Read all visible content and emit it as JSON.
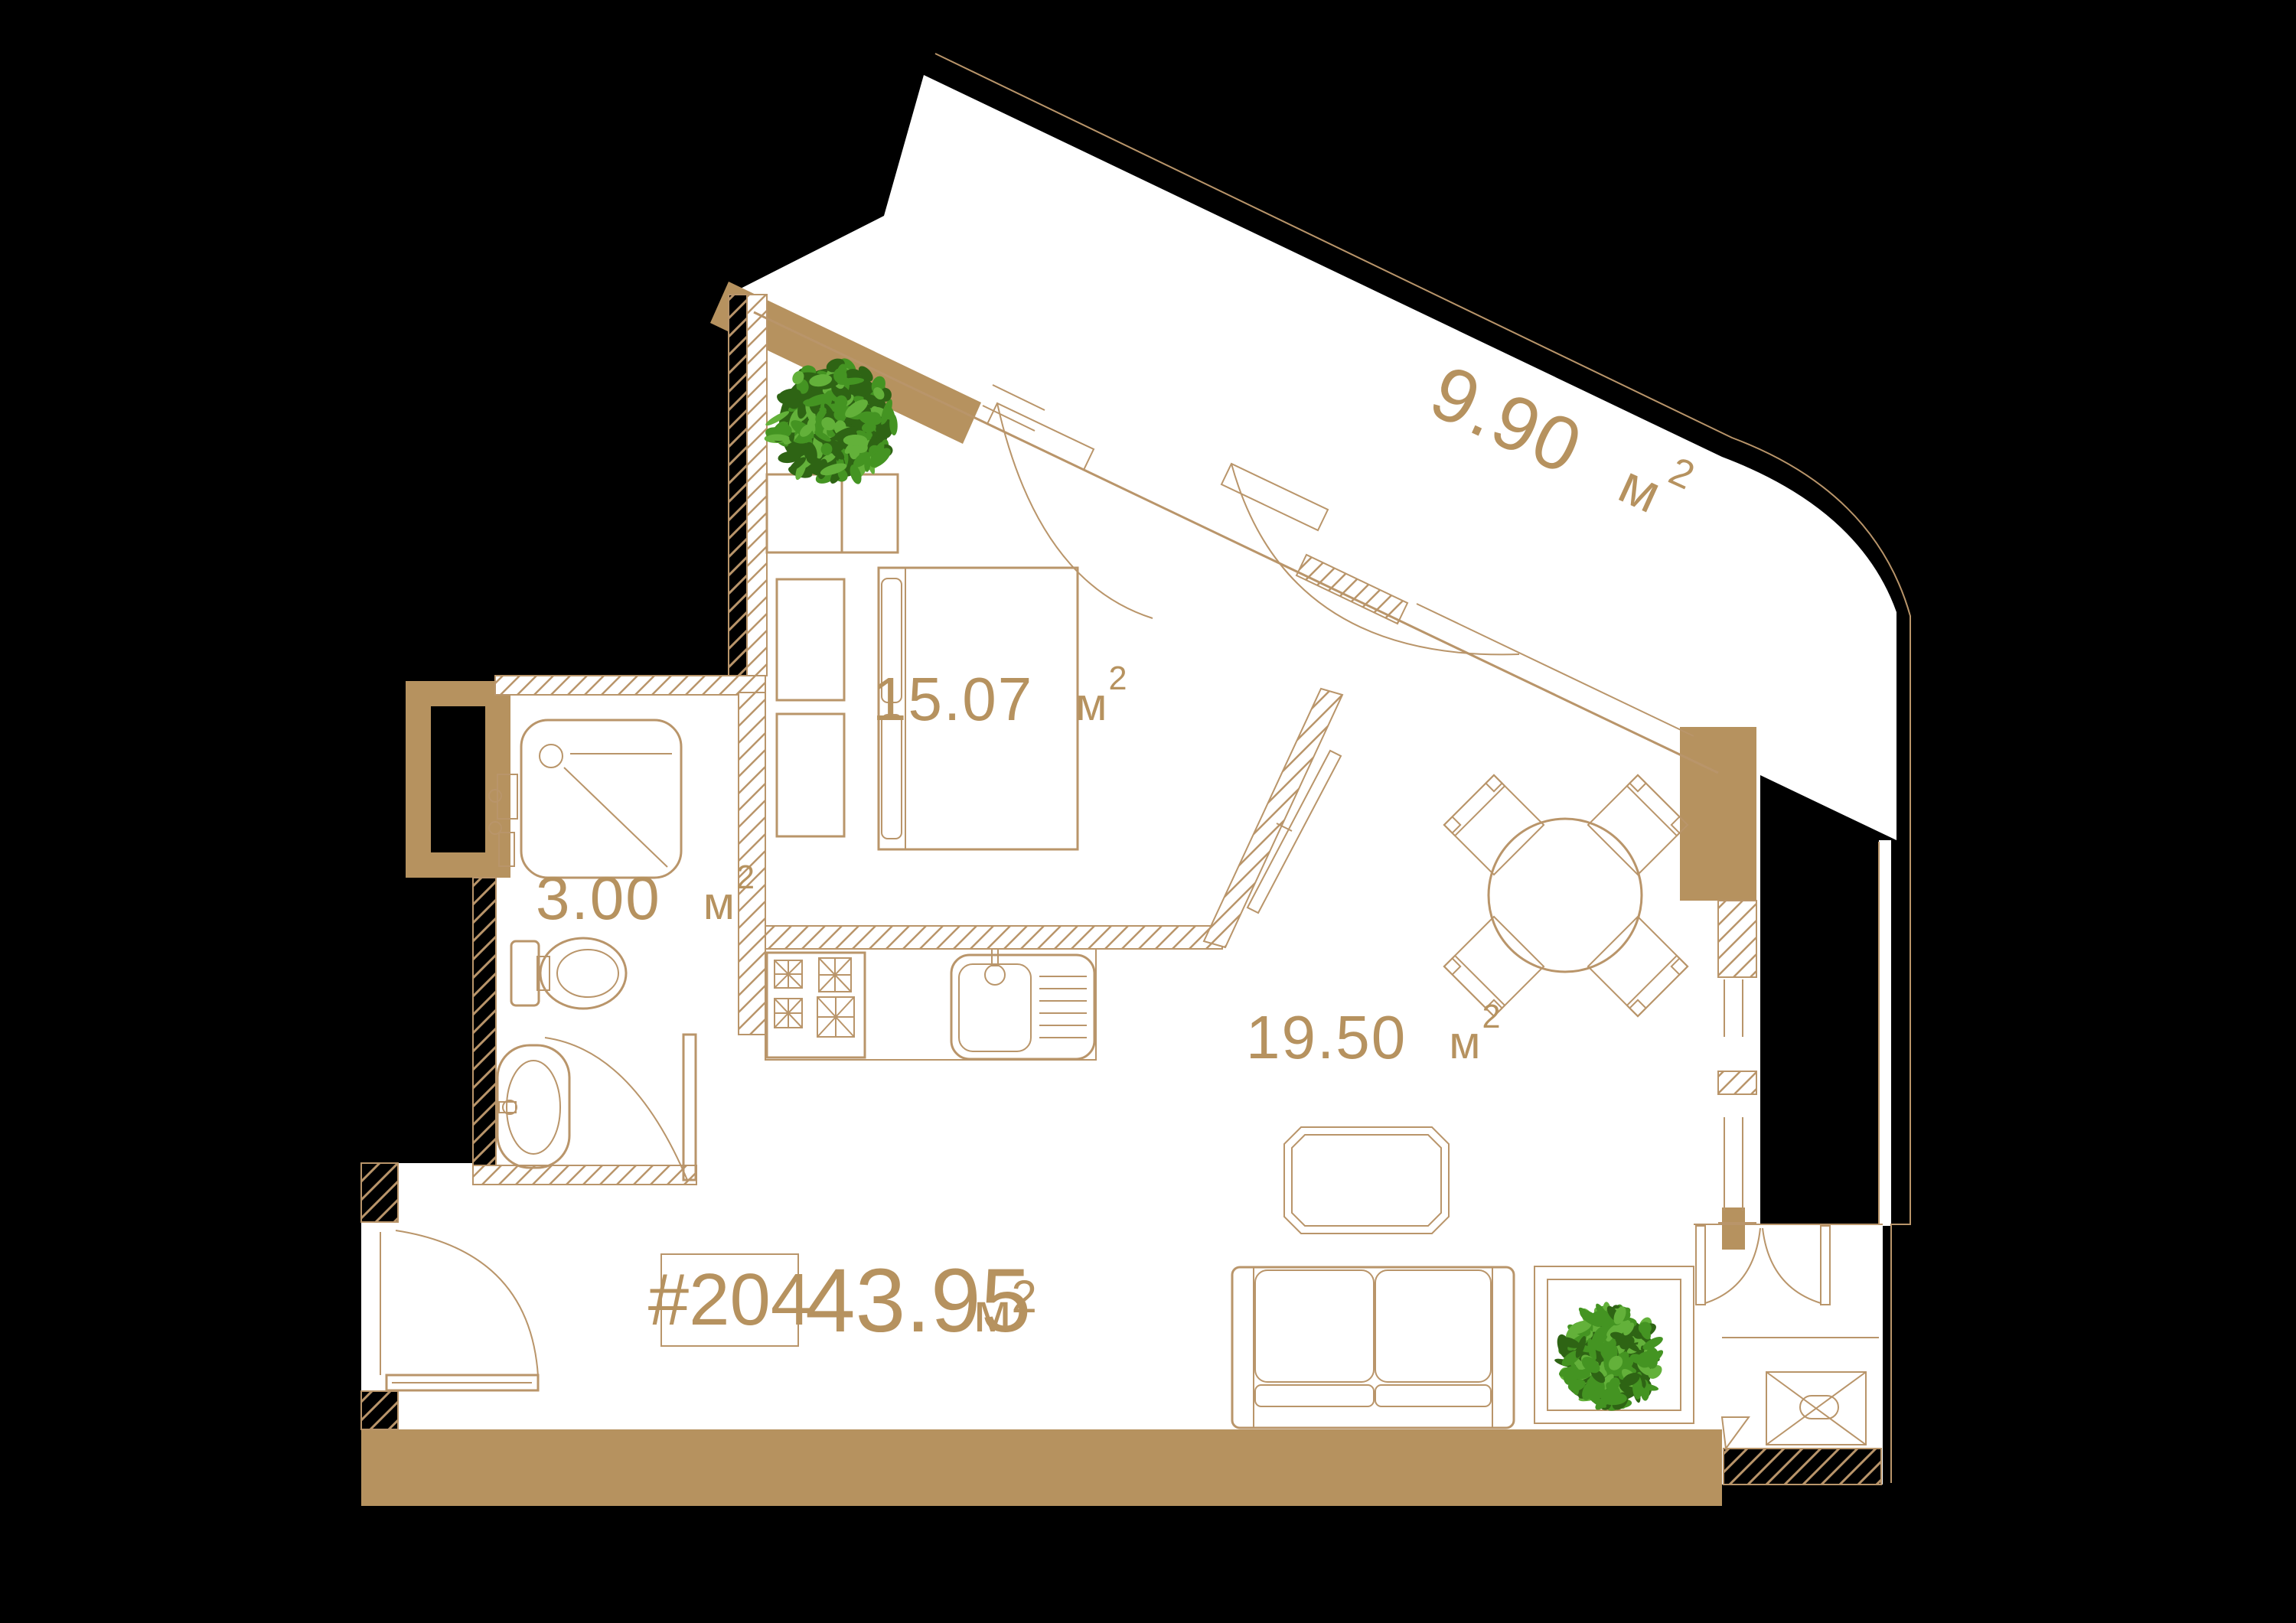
{
  "title": "Apartment floor plan",
  "unit": {
    "number": "#204",
    "area": "43.95"
  },
  "area_unit": {
    "symbol": "м",
    "sup": "2"
  },
  "rooms": {
    "balcony": {
      "area": "9.90"
    },
    "bedroom": {
      "area": "15.07"
    },
    "bathroom": {
      "area": "3.00"
    },
    "living": {
      "area": "19.50"
    }
  },
  "colors": {
    "background": "#000000",
    "floor": "#ffffff",
    "wall_fill": "#b6925f",
    "line": "#b9956a",
    "text": "#b6925f",
    "plant_dark": "#2e6414",
    "plant_mid": "#449422",
    "plant_light": "#63b13a"
  }
}
